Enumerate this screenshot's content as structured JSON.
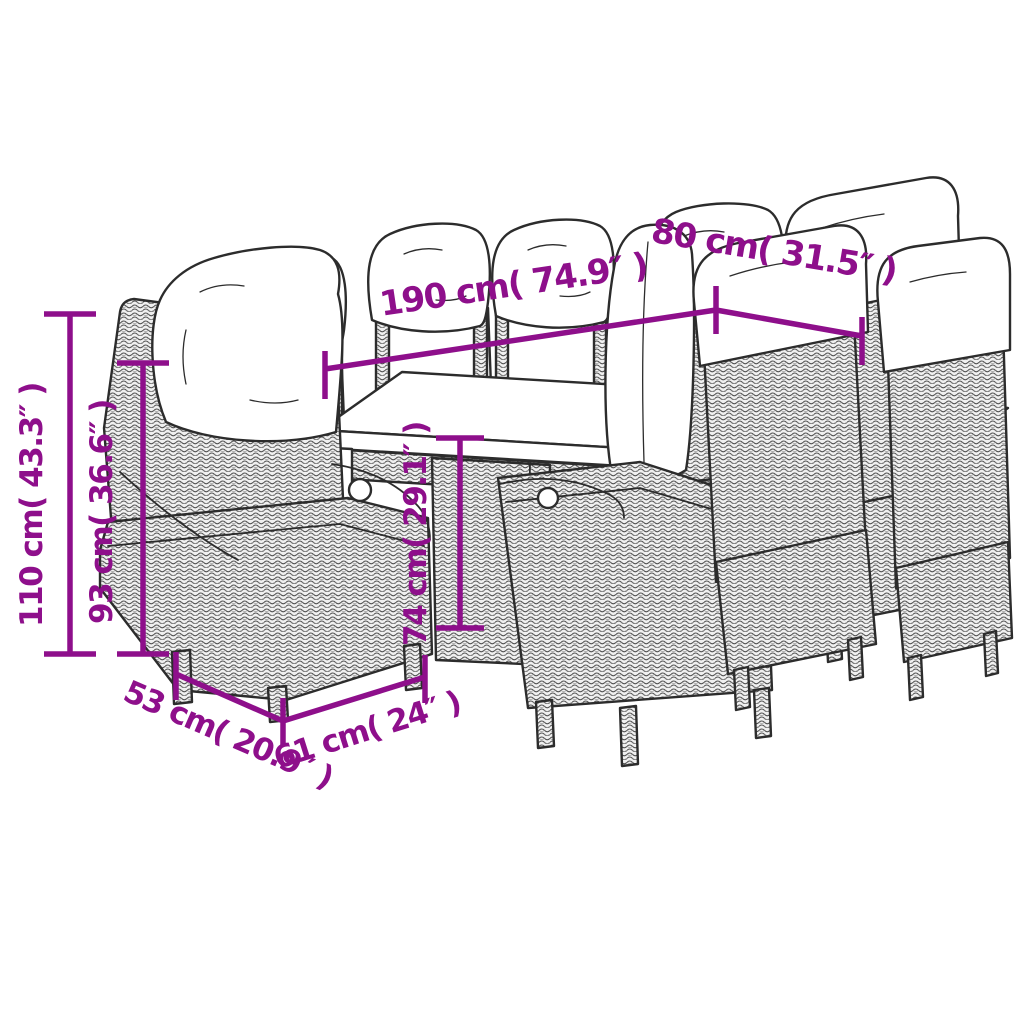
{
  "page": {
    "subject": "Product dimension diagram – poly rattan garden dining set (rectangular table with eight reclining cushioned chairs)",
    "background_color": "#ffffff"
  },
  "style": {
    "annotation_color": "#8E0F8B",
    "line_art_color": "#2c2c2c",
    "cushion_color": "#ffffff"
  },
  "dims": {
    "table_length": {
      "value_cm": 190,
      "value_in": 74.9,
      "label": "190 cm( 74.9″ )"
    },
    "table_width": {
      "value_cm": 80,
      "value_in": 31.5,
      "label": "80 cm( 31.5″ )"
    },
    "chair_total_height": {
      "value_cm": 110,
      "value_in": 43.3,
      "label": "110 cm( 43.3″ )"
    },
    "chair_back_height": {
      "value_cm": 93,
      "value_in": 36.6,
      "label": "93 cm( 36.6″ )"
    },
    "table_height": {
      "value_cm": 74,
      "value_in": 29.1,
      "label": "74 cm( 29.1″ )"
    },
    "chair_depth": {
      "value_cm": 53,
      "value_in": 20.9,
      "label": "53 cm( 20.9″ )"
    },
    "chair_width": {
      "value_cm": 61,
      "value_in": 24,
      "label": "61 cm( 24″ )"
    }
  }
}
